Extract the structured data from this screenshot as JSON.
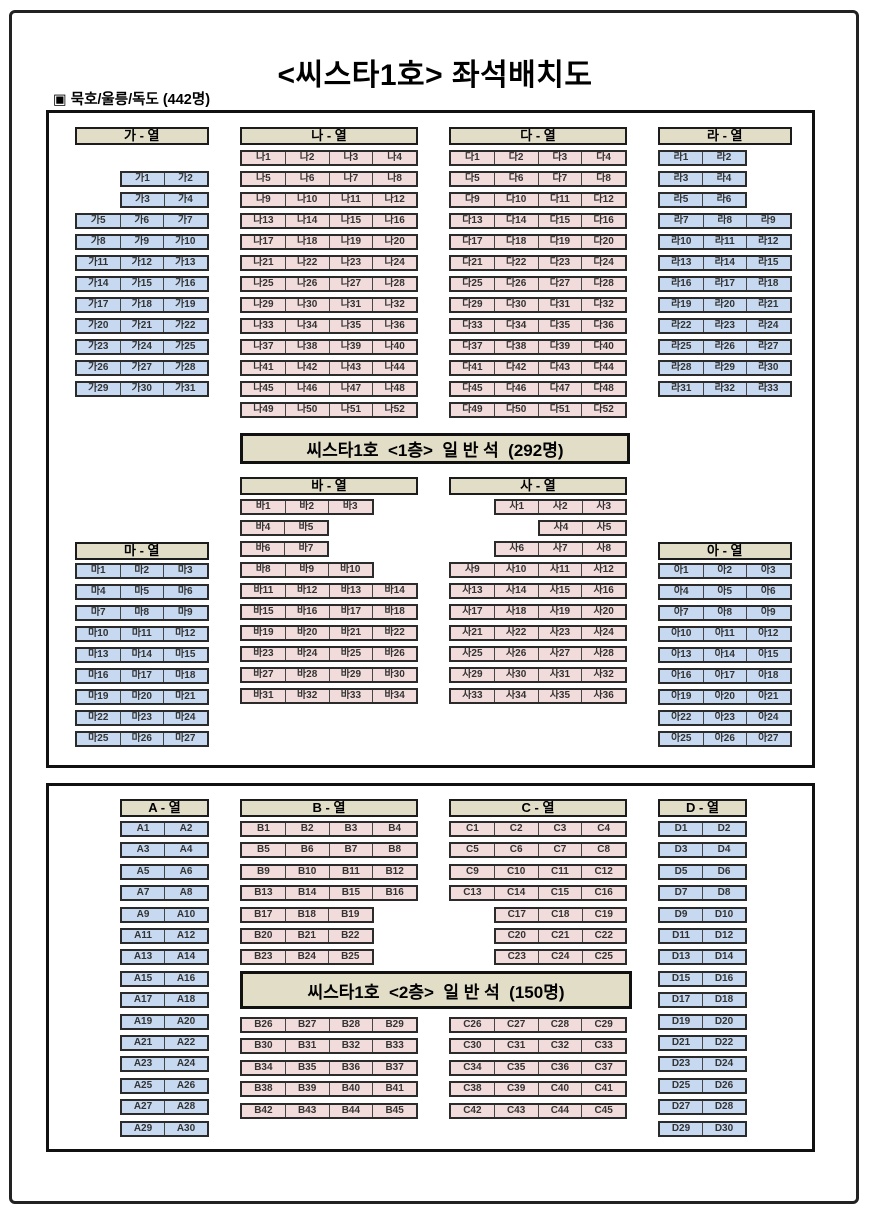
{
  "title": "<씨스타1호> 좌석배치도",
  "subtitle": "▣ 묵호/울릉/독도 (442명)",
  "colors": {
    "seat_blue": "#c6d9f1",
    "seat_pink": "#f2dcdb",
    "panel_tan": "#e2ddc6",
    "seat_text": "#333333"
  },
  "deck1": {
    "banner": "씨스타1호  <1층>  일 반 석  (292명)",
    "groups": [
      {
        "id": "ga",
        "header": "가 - 열",
        "color": "blue",
        "x": 75,
        "header_y": 127,
        "rows_y": 171,
        "pitch": 21,
        "cols": 3,
        "rows": [
          [
            null,
            "가1",
            "가2"
          ],
          [
            null,
            "가3",
            "가4"
          ],
          [
            "가5",
            "가6",
            "가7"
          ],
          [
            "가8",
            "가9",
            "가10"
          ],
          [
            "가11",
            "가12",
            "가13"
          ],
          [
            "가14",
            "가15",
            "가16"
          ],
          [
            "가17",
            "가18",
            "가19"
          ],
          [
            "가20",
            "가21",
            "가22"
          ],
          [
            "가23",
            "가24",
            "가25"
          ],
          [
            "가26",
            "가27",
            "가28"
          ],
          [
            "가29",
            "가30",
            "가31"
          ]
        ]
      },
      {
        "id": "na",
        "header": "나 - 열",
        "color": "pink",
        "x": 240,
        "header_y": 127,
        "rows_y": 150,
        "pitch": 21,
        "cols": 4,
        "rows": [
          [
            "나1",
            "나2",
            "나3",
            "나4"
          ],
          [
            "나5",
            "나6",
            "나7",
            "나8"
          ],
          [
            "나9",
            "나10",
            "나11",
            "나12"
          ],
          [
            "나13",
            "나14",
            "나15",
            "나16"
          ],
          [
            "나17",
            "나18",
            "나19",
            "나20"
          ],
          [
            "나21",
            "나22",
            "나23",
            "나24"
          ],
          [
            "나25",
            "나26",
            "나27",
            "나28"
          ],
          [
            "나29",
            "나30",
            "나31",
            "나32"
          ],
          [
            "나33",
            "나34",
            "나35",
            "나36"
          ],
          [
            "나37",
            "나38",
            "나39",
            "나40"
          ],
          [
            "나41",
            "나42",
            "나43",
            "나44"
          ],
          [
            "나45",
            "나46",
            "나47",
            "나48"
          ],
          [
            "나49",
            "나50",
            "나51",
            "나52"
          ]
        ]
      },
      {
        "id": "da",
        "header": "다 - 열",
        "color": "pink",
        "x": 449,
        "header_y": 127,
        "rows_y": 150,
        "pitch": 21,
        "cols": 4,
        "rows": [
          [
            "다1",
            "다2",
            "다3",
            "다4"
          ],
          [
            "다5",
            "다6",
            "다7",
            "다8"
          ],
          [
            "다9",
            "다10",
            "다11",
            "다12"
          ],
          [
            "다13",
            "다14",
            "다15",
            "다16"
          ],
          [
            "다17",
            "다18",
            "다19",
            "다20"
          ],
          [
            "다21",
            "다22",
            "다23",
            "다24"
          ],
          [
            "다25",
            "다26",
            "다27",
            "다28"
          ],
          [
            "다29",
            "다30",
            "다31",
            "다32"
          ],
          [
            "다33",
            "다34",
            "다35",
            "다36"
          ],
          [
            "다37",
            "다38",
            "다39",
            "다40"
          ],
          [
            "다41",
            "다42",
            "다43",
            "다44"
          ],
          [
            "다45",
            "다46",
            "다47",
            "다48"
          ],
          [
            "다49",
            "다50",
            "다51",
            "다52"
          ]
        ]
      },
      {
        "id": "ra",
        "header": "라 - 열",
        "color": "blue",
        "x": 658,
        "header_y": 127,
        "rows_y": 150,
        "pitch": 21,
        "cols": 3,
        "rows": [
          [
            "라1",
            "라2",
            null
          ],
          [
            "라3",
            "라4",
            null
          ],
          [
            "라5",
            "라6",
            null
          ],
          [
            "라7",
            "라8",
            "라9"
          ],
          [
            "라10",
            "라11",
            "라12"
          ],
          [
            "라13",
            "라14",
            "라15"
          ],
          [
            "라16",
            "라17",
            "라18"
          ],
          [
            "라19",
            "라20",
            "라21"
          ],
          [
            "라22",
            "라23",
            "라24"
          ],
          [
            "라25",
            "라26",
            "라27"
          ],
          [
            "라28",
            "라29",
            "라30"
          ],
          [
            "라31",
            "라32",
            "라33"
          ]
        ]
      },
      {
        "id": "ma",
        "header": "마 - 열",
        "color": "blue",
        "x": 75,
        "header_y": 542,
        "rows_y": 563,
        "pitch": 21,
        "cols": 3,
        "rows": [
          [
            "마1",
            "마2",
            "마3"
          ],
          [
            "마4",
            "마5",
            "마6"
          ],
          [
            "마7",
            "마8",
            "마9"
          ],
          [
            "마10",
            "마11",
            "마12"
          ],
          [
            "마13",
            "마14",
            "마15"
          ],
          [
            "마16",
            "마17",
            "마18"
          ],
          [
            "마19",
            "마20",
            "마21"
          ],
          [
            "마22",
            "마23",
            "마24"
          ],
          [
            "마25",
            "마26",
            "마27"
          ]
        ]
      },
      {
        "id": "ba",
        "header": "바 - 열",
        "color": "pink",
        "x": 240,
        "header_y": 477,
        "rows_y": 499,
        "pitch": 21,
        "cols": 4,
        "rows": [
          [
            "바1",
            "바2",
            "바3",
            null
          ],
          [
            "바4",
            "바5",
            null,
            null
          ],
          [
            "바6",
            "바7",
            null,
            null
          ],
          [
            "바8",
            "바9",
            "바10",
            null
          ],
          [
            "바11",
            "바12",
            "바13",
            "바14"
          ],
          [
            "바15",
            "바16",
            "바17",
            "바18"
          ],
          [
            "바19",
            "바20",
            "바21",
            "바22"
          ],
          [
            "바23",
            "바24",
            "바25",
            "바26"
          ],
          [
            "바27",
            "바28",
            "바29",
            "바30"
          ],
          [
            "바31",
            "바32",
            "바33",
            "바34"
          ]
        ]
      },
      {
        "id": "sa",
        "header": "사 - 열",
        "color": "pink",
        "x": 449,
        "header_y": 477,
        "rows_y": 499,
        "pitch": 21,
        "cols": 4,
        "rows": [
          [
            null,
            "사1",
            "사2",
            "사3"
          ],
          [
            null,
            null,
            "사4",
            "사5"
          ],
          [
            null,
            "사6",
            "사7",
            "사8"
          ],
          [
            "사9",
            "사10",
            "사11",
            "사12"
          ],
          [
            "사13",
            "사14",
            "사15",
            "사16"
          ],
          [
            "사17",
            "사18",
            "사19",
            "사20"
          ],
          [
            "사21",
            "사22",
            "사23",
            "사24"
          ],
          [
            "사25",
            "사26",
            "사27",
            "사28"
          ],
          [
            "사29",
            "사30",
            "사31",
            "사32"
          ],
          [
            "사33",
            "사34",
            "사35",
            "사36"
          ]
        ]
      },
      {
        "id": "ah",
        "header": "아 - 열",
        "color": "blue",
        "x": 658,
        "header_y": 542,
        "rows_y": 563,
        "pitch": 21,
        "cols": 3,
        "rows": [
          [
            "아1",
            "아2",
            "아3"
          ],
          [
            "아4",
            "아5",
            "아6"
          ],
          [
            "아7",
            "아8",
            "아9"
          ],
          [
            "아10",
            "아11",
            "아12"
          ],
          [
            "아13",
            "아14",
            "아15"
          ],
          [
            "아16",
            "아17",
            "아18"
          ],
          [
            "아19",
            "아20",
            "아21"
          ],
          [
            "아22",
            "아23",
            "아24"
          ],
          [
            "아25",
            "아26",
            "아27"
          ]
        ]
      }
    ]
  },
  "deck2": {
    "banner": "씨스타1호  <2층>  일 반 석  (150명)",
    "groups": [
      {
        "id": "A",
        "header": "A - 열",
        "color": "blue",
        "x": 120,
        "header_y": 799,
        "rows_y": 821,
        "pitch": 21.4,
        "cols": 2,
        "rows": [
          [
            "A1",
            "A2"
          ],
          [
            "A3",
            "A4"
          ],
          [
            "A5",
            "A6"
          ],
          [
            "A7",
            "A8"
          ],
          [
            "A9",
            "A10"
          ],
          [
            "A11",
            "A12"
          ],
          [
            "A13",
            "A14"
          ],
          [
            "A15",
            "A16"
          ],
          [
            "A17",
            "A18"
          ],
          [
            "A19",
            "A20"
          ],
          [
            "A21",
            "A22"
          ],
          [
            "A23",
            "A24"
          ],
          [
            "A25",
            "A26"
          ],
          [
            "A27",
            "A28"
          ],
          [
            "A29",
            "A30"
          ]
        ]
      },
      {
        "id": "B-upper",
        "header": "B - 열",
        "color": "pink",
        "x": 240,
        "header_y": 799,
        "rows_y": 821,
        "pitch": 21.4,
        "cols": 4,
        "rows": [
          [
            "B1",
            "B2",
            "B3",
            "B4"
          ],
          [
            "B5",
            "B6",
            "B7",
            "B8"
          ],
          [
            "B9",
            "B10",
            "B11",
            "B12"
          ],
          [
            "B13",
            "B14",
            "B15",
            "B16"
          ],
          [
            "B17",
            "B18",
            "B19",
            null
          ],
          [
            "B20",
            "B21",
            "B22",
            null
          ],
          [
            "B23",
            "B24",
            "B25",
            null
          ]
        ]
      },
      {
        "id": "C-upper",
        "header": "C - 열",
        "color": "pink",
        "x": 449,
        "header_y": 799,
        "rows_y": 821,
        "pitch": 21.4,
        "cols": 4,
        "rows": [
          [
            "C1",
            "C2",
            "C3",
            "C4"
          ],
          [
            "C5",
            "C6",
            "C7",
            "C8"
          ],
          [
            "C9",
            "C10",
            "C11",
            "C12"
          ],
          [
            "C13",
            "C14",
            "C15",
            "C16"
          ],
          [
            null,
            "C17",
            "C18",
            "C19"
          ],
          [
            null,
            "C20",
            "C21",
            "C22"
          ],
          [
            null,
            "C23",
            "C24",
            "C25"
          ]
        ]
      },
      {
        "id": "D",
        "header": "D - 열",
        "color": "blue",
        "x": 658,
        "header_y": 799,
        "rows_y": 821,
        "pitch": 21.4,
        "cols": 2,
        "rows": [
          [
            "D1",
            "D2"
          ],
          [
            "D3",
            "D4"
          ],
          [
            "D5",
            "D6"
          ],
          [
            "D7",
            "D8"
          ],
          [
            "D9",
            "D10"
          ],
          [
            "D11",
            "D12"
          ],
          [
            "D13",
            "D14"
          ],
          [
            "D15",
            "D16"
          ],
          [
            "D17",
            "D18"
          ],
          [
            "D19",
            "D20"
          ],
          [
            "D21",
            "D22"
          ],
          [
            "D23",
            "D24"
          ],
          [
            "D25",
            "D26"
          ],
          [
            "D27",
            "D28"
          ],
          [
            "D29",
            "D30"
          ]
        ]
      },
      {
        "id": "B-lower",
        "header": null,
        "color": "pink",
        "x": 240,
        "rows_y": 1017,
        "pitch": 21.4,
        "cols": 4,
        "rows": [
          [
            "B26",
            "B27",
            "B28",
            "B29"
          ],
          [
            "B30",
            "B31",
            "B32",
            "B33"
          ],
          [
            "B34",
            "B35",
            "B36",
            "B37"
          ],
          [
            "B38",
            "B39",
            "B40",
            "B41"
          ],
          [
            "B42",
            "B43",
            "B44",
            "B45"
          ]
        ]
      },
      {
        "id": "C-lower",
        "header": null,
        "color": "pink",
        "x": 449,
        "rows_y": 1017,
        "pitch": 21.4,
        "cols": 4,
        "rows": [
          [
            "C26",
            "C27",
            "C28",
            "C29"
          ],
          [
            "C30",
            "C31",
            "C32",
            "C33"
          ],
          [
            "C34",
            "C35",
            "C36",
            "C37"
          ],
          [
            "C38",
            "C39",
            "C40",
            "C41"
          ],
          [
            "C42",
            "C43",
            "C44",
            "C45"
          ]
        ]
      }
    ]
  }
}
